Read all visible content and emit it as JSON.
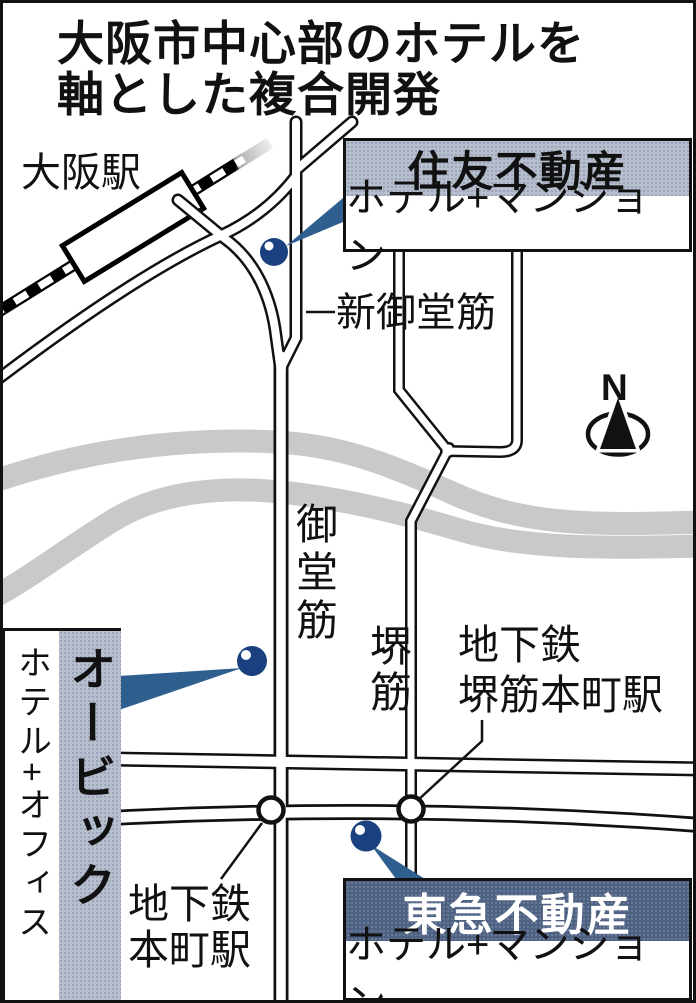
{
  "title": {
    "line1": "大阪市中心部のホテルを",
    "line2": "軸とした複合開発"
  },
  "map": {
    "osaka_station": "大阪駅",
    "road_shin_midosuji": "新御堂筋",
    "road_midosuji": "御堂筋",
    "road_sakaisuji": "堺筋",
    "station_sakaisuji_hommachi_line1": "地下鉄",
    "station_sakaisuji_hommachi_line2": "堺筋本町駅",
    "station_hommachi_line1": "地下鉄",
    "station_hommachi_line2": "本町駅",
    "compass": "N"
  },
  "developments": {
    "sumitomo": {
      "company": "住友不動産",
      "project": "ホテル+マンション"
    },
    "obic": {
      "company": "オービック",
      "project": "ホテル+オフィス"
    },
    "tokyu": {
      "company": "東急不動産",
      "project": "ホテル+マンション"
    }
  },
  "colors": {
    "header_light": "#b7bfcf",
    "header_dark": "#4e6183",
    "pin": "#1a4080",
    "pin_highlight": "#ffffff",
    "pointer": "#2e5f8e",
    "river": "#c9c9c9",
    "road_casing": "#111111",
    "railway": "#000000"
  }
}
